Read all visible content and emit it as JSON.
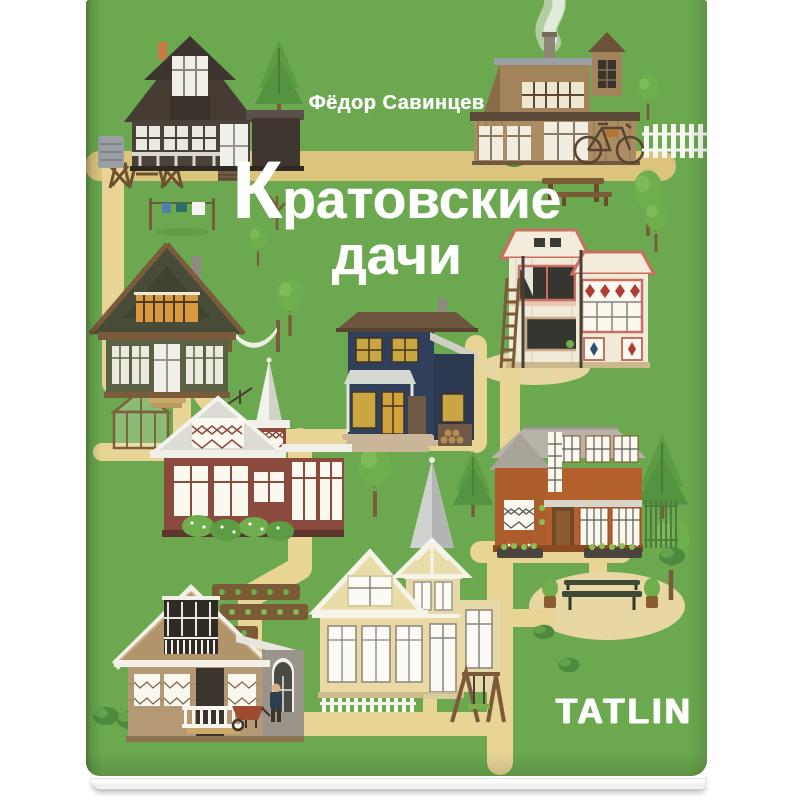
{
  "book": {
    "author": "Фёдор Савинцев",
    "title_initial": "К",
    "title_line1_rest": "ратовские",
    "title_line2": "дачи",
    "publisher": "TATLIN"
  },
  "colors": {
    "cover_green": "#6ba84f",
    "path_yellow": "#e8d494",
    "path_tan": "#dcc47d",
    "plaza_sand": "#e9d7a3",
    "title_color": "#ffffff"
  },
  "scene": {
    "houses": [
      {
        "name": "dark-brown-gambrel-house",
        "position": "top-left"
      },
      {
        "name": "tan-house-with-smoking-chimney",
        "position": "top-right"
      },
      {
        "name": "green-gable-house",
        "position": "middle-left"
      },
      {
        "name": "cream-house-with-ladder",
        "position": "middle-right"
      },
      {
        "name": "navy-blue-house",
        "position": "center"
      },
      {
        "name": "red-house-with-white-spire",
        "position": "center-left"
      },
      {
        "name": "orange-house",
        "position": "center-right"
      },
      {
        "name": "cream-tower-house-with-spire",
        "position": "bottom-center"
      },
      {
        "name": "tan-cottage-with-grey-annex",
        "position": "bottom-left"
      }
    ],
    "props": [
      "clothesline",
      "hammock",
      "greenhouse",
      "picnic-table",
      "garden-table-and-chairs",
      "bicycle",
      "white-picket-fence",
      "park-bench",
      "swing-set",
      "garden-beds",
      "wheelbarrow",
      "gardener-figure",
      "chimney-smoke",
      "trees",
      "bushes",
      "yellow-paths"
    ]
  }
}
